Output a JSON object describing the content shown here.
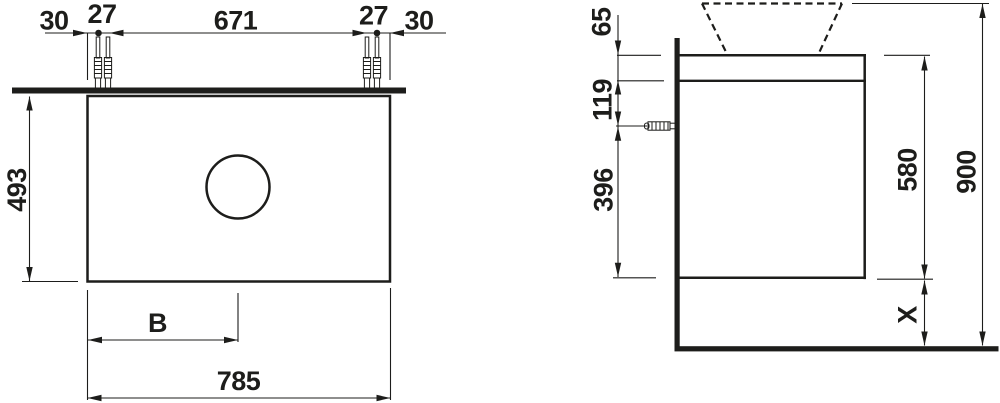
{
  "colors": {
    "line": "#1d1d1b",
    "background": "#ffffff"
  },
  "front_view": {
    "top_dims": {
      "overhang_left": "30",
      "dowel_gap_left": "27",
      "dowel_span": "671",
      "dowel_gap_right": "27",
      "overhang_right": "30"
    },
    "cabinet_height": "493",
    "center_offset": "B",
    "cabinet_width": "785"
  },
  "side_view": {
    "top_rail_height": "65",
    "rail_to_dowel": "119",
    "dowel_to_bottom": "396",
    "carcass_height": "580",
    "total_height": "900",
    "floor_clearance": "X"
  }
}
